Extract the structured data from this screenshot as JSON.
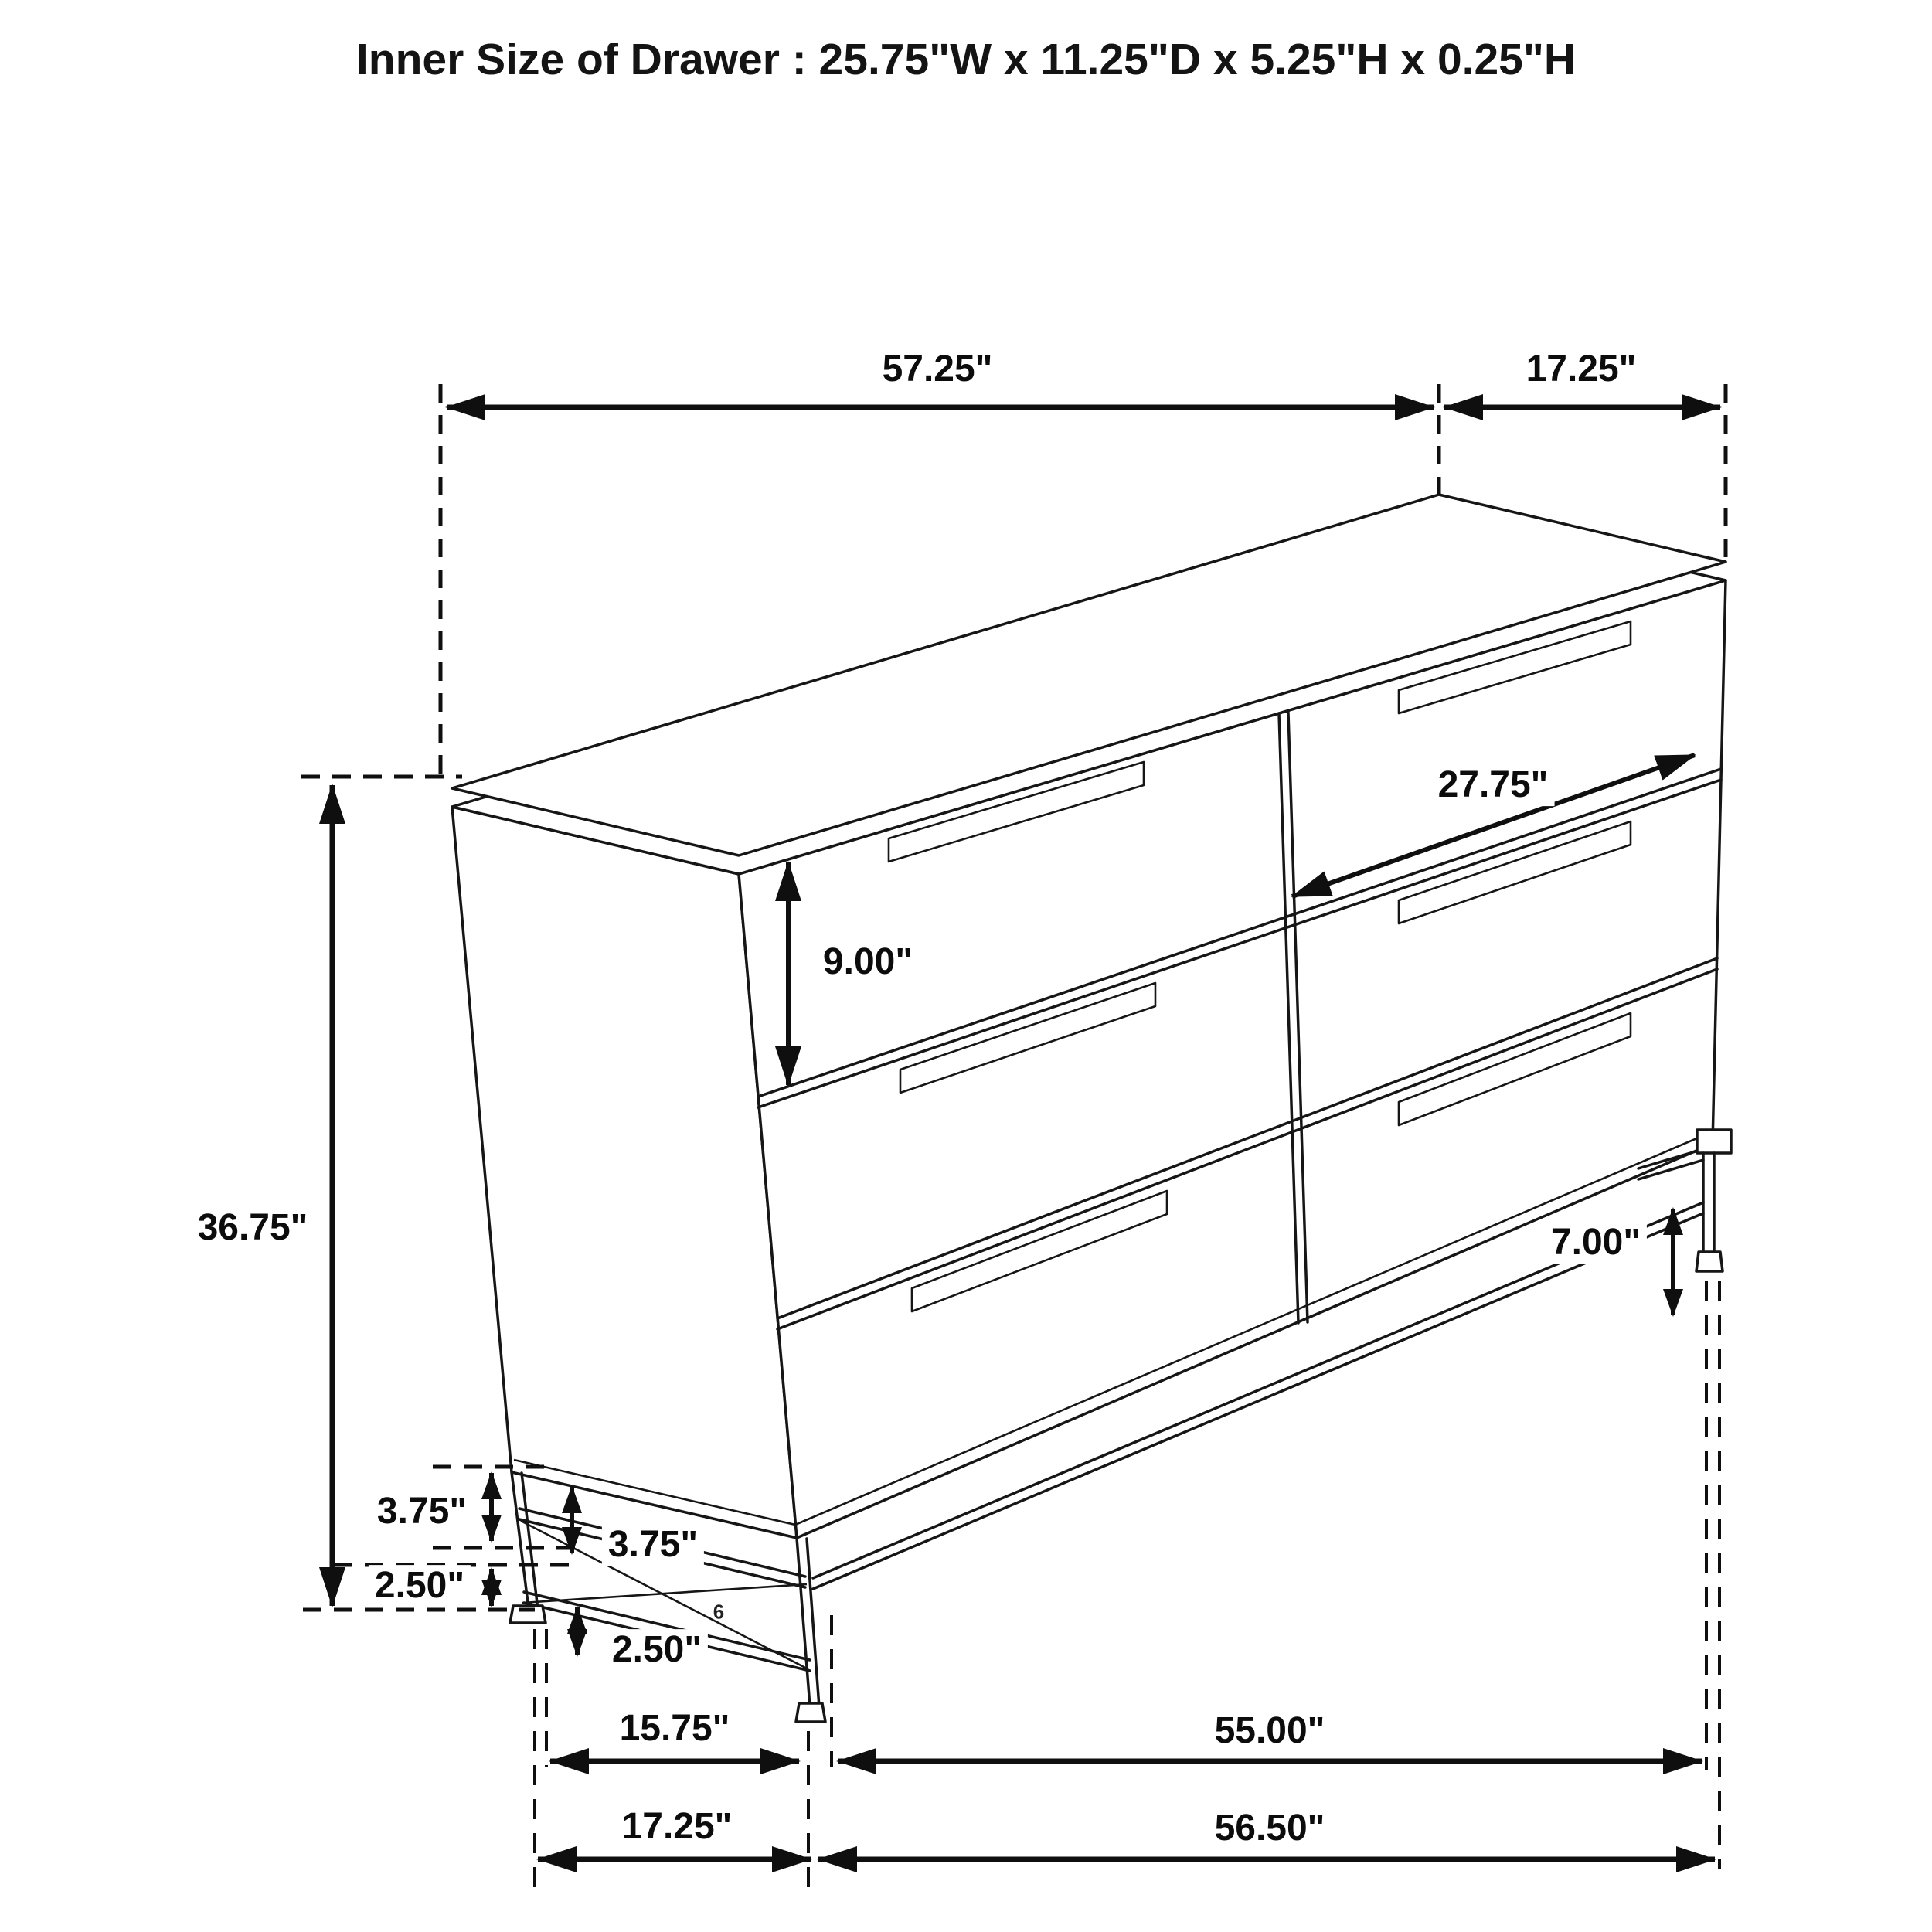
{
  "page_background": "#ffffff",
  "ink_color": "#111111",
  "title": "Inner Size of Drawer : 25.75\"W x 11.25\"D x 5.25\"H x 0.25\"H",
  "figure": {
    "type": "isometric-furniture-dimension-diagram",
    "subject": "six-drawer dresser on metal base frame",
    "drawer_layout": "2 columns x 3 rows",
    "artifact_mark": "6"
  },
  "dimensions": {
    "top_front_width": "57.25\"",
    "top_side_depth": "17.25\"",
    "overall_height": "36.75\"",
    "drawer_front_height": "9.00\"",
    "drawer_opening_width": "27.75\"",
    "right_leg_height": "7.00\"",
    "base_upper_gap_outer": "3.75\"",
    "base_upper_gap_inner": "3.75\"",
    "base_lower_gap_outer": "2.50\"",
    "base_lower_gap_inner": "2.50\"",
    "base_side_depth": "15.75\"",
    "base_front_width": "55.00\"",
    "base_side_depth_overall": "17.25\"",
    "base_front_width_overall": "56.50\""
  }
}
